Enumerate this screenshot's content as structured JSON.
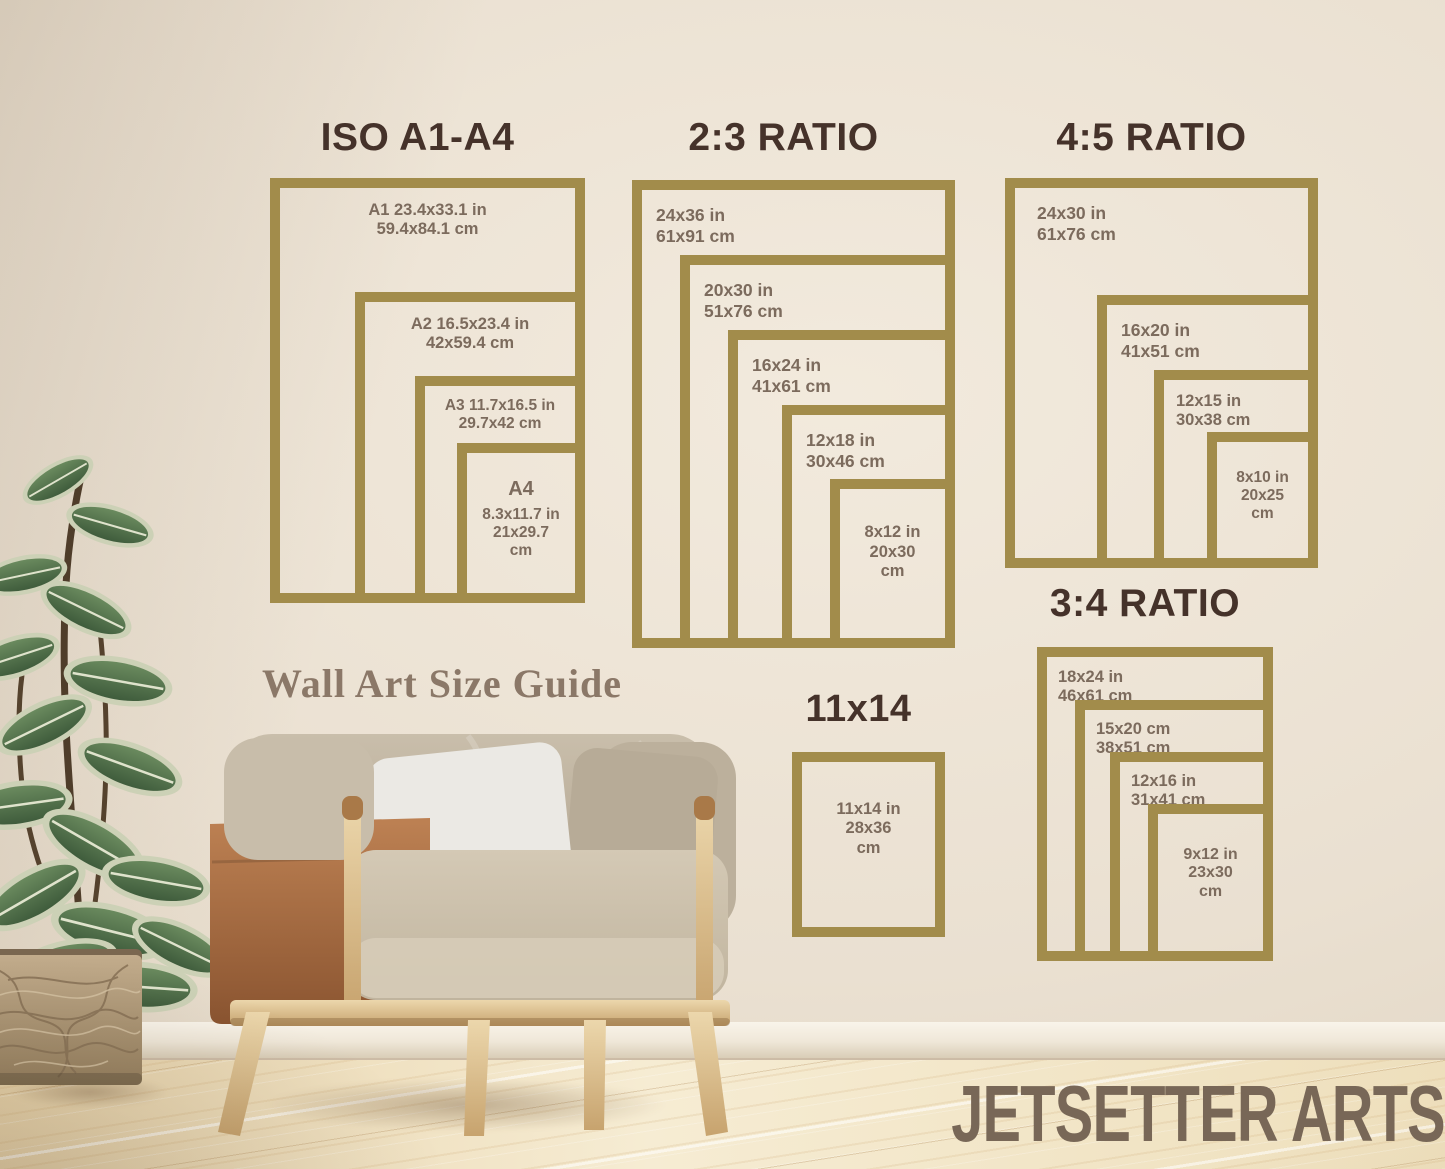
{
  "branding": {
    "watermark": "JETSETTER ARTS",
    "guide_title": "Wall Art Size Guide"
  },
  "colors": {
    "frame_gold": "#a28c4b",
    "heading_brown": "#45322a",
    "label_brown": "#7c6b5d",
    "wall_cream": "#ece2d4",
    "floor_wood": "#f0e2c2"
  },
  "groups": {
    "iso": {
      "title": "ISO A1-A4",
      "frames": [
        {
          "lines": [
            "A1 23.4x33.1 in",
            "59.4x84.1 cm"
          ]
        },
        {
          "lines": [
            "A2 16.5x23.4 in",
            "42x59.4 cm"
          ]
        },
        {
          "lines": [
            "A3 11.7x16.5 in",
            "29.7x42 cm"
          ]
        },
        {
          "lines": [
            "A4",
            "8.3x11.7 in",
            "21x29.7",
            "cm"
          ]
        }
      ]
    },
    "ratio23": {
      "title": "2:3 RATIO",
      "frames": [
        {
          "lines": [
            "24x36 in",
            "61x91 cm"
          ]
        },
        {
          "lines": [
            "20x30 in",
            "51x76 cm"
          ]
        },
        {
          "lines": [
            "16x24 in",
            "41x61 cm"
          ]
        },
        {
          "lines": [
            "12x18 in",
            "30x46 cm"
          ]
        },
        {
          "lines": [
            "8x12 in",
            "20x30",
            "cm"
          ]
        }
      ]
    },
    "ratio45": {
      "title": "4:5 RATIO",
      "frames": [
        {
          "lines": [
            "24x30 in",
            "61x76 cm"
          ]
        },
        {
          "lines": [
            "16x20 in",
            "41x51 cm"
          ]
        },
        {
          "lines": [
            "12x15 in",
            "30x38 cm"
          ]
        },
        {
          "lines": [
            "8x10 in",
            "20x25",
            "cm"
          ]
        }
      ]
    },
    "ratio34": {
      "title": "3:4 RATIO",
      "frames": [
        {
          "lines": [
            "18x24 in",
            "46x61 cm"
          ]
        },
        {
          "lines": [
            "15x20 cm",
            "38x51 cm"
          ]
        },
        {
          "lines": [
            "12x16 in",
            "31x41 cm"
          ]
        },
        {
          "lines": [
            "9x12 in",
            "23x30",
            "cm"
          ]
        }
      ]
    },
    "size1114": {
      "title": "11x14",
      "frames": [
        {
          "lines": [
            "11x14 in",
            "28x36",
            "cm"
          ]
        }
      ]
    }
  }
}
